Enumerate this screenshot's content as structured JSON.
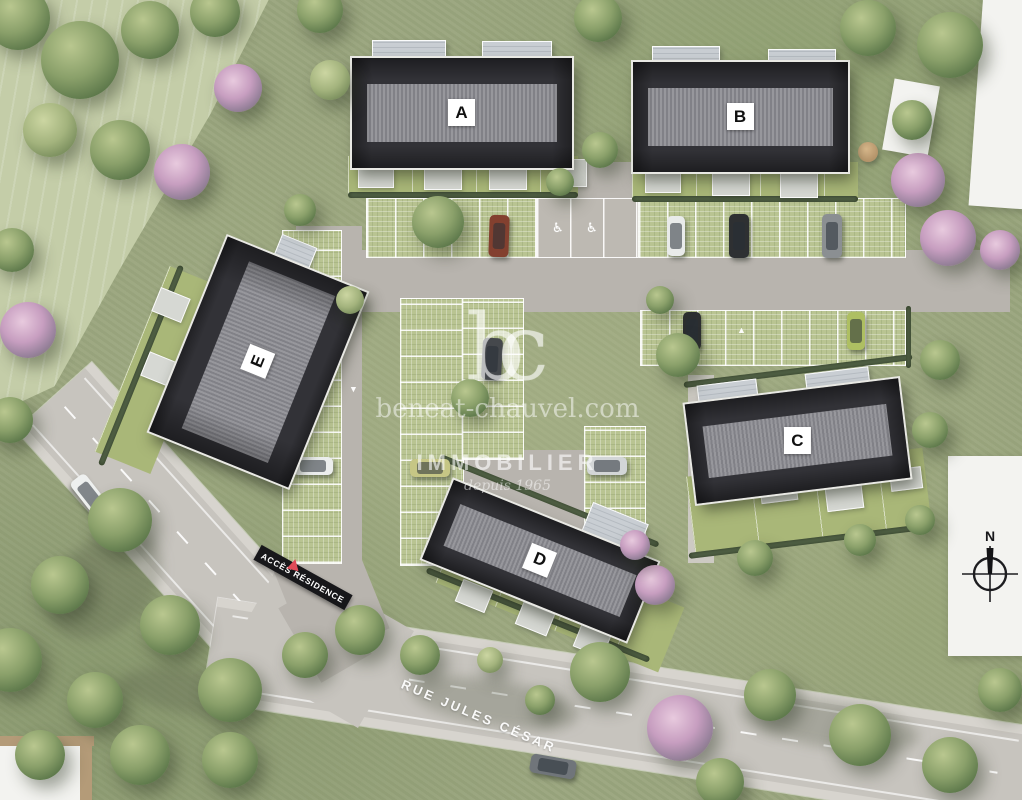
{
  "watermark": {
    "logo": "bc",
    "website": "beneat-chauvel.com",
    "brand": "IMMOBILIER",
    "tagline": "depuis 1965"
  },
  "buildings": [
    {
      "id": "A",
      "label": "A"
    },
    {
      "id": "B",
      "label": "B"
    },
    {
      "id": "C",
      "label": "C"
    },
    {
      "id": "D",
      "label": "D"
    },
    {
      "id": "E",
      "label": "E"
    }
  ],
  "signs": {
    "access_banner": "ACCÈS RÉSIDENCE",
    "street_name": "RUE JULES CÉSAR"
  },
  "compass": {
    "label": "N"
  },
  "parking": {
    "disabled_symbol": "♿",
    "arrow_symbol": "▲"
  },
  "colors": {
    "grass": "#9aa57e",
    "field": "#c4cda8",
    "road": "#c7c4be",
    "paver_green": "#b9c492",
    "roof_dark": "#323237",
    "roof_band": "#97979c",
    "hedge_green": "#56664a",
    "accent_red": "#e04b58",
    "watermark_white": "rgba(255,255,255,0.55)"
  }
}
